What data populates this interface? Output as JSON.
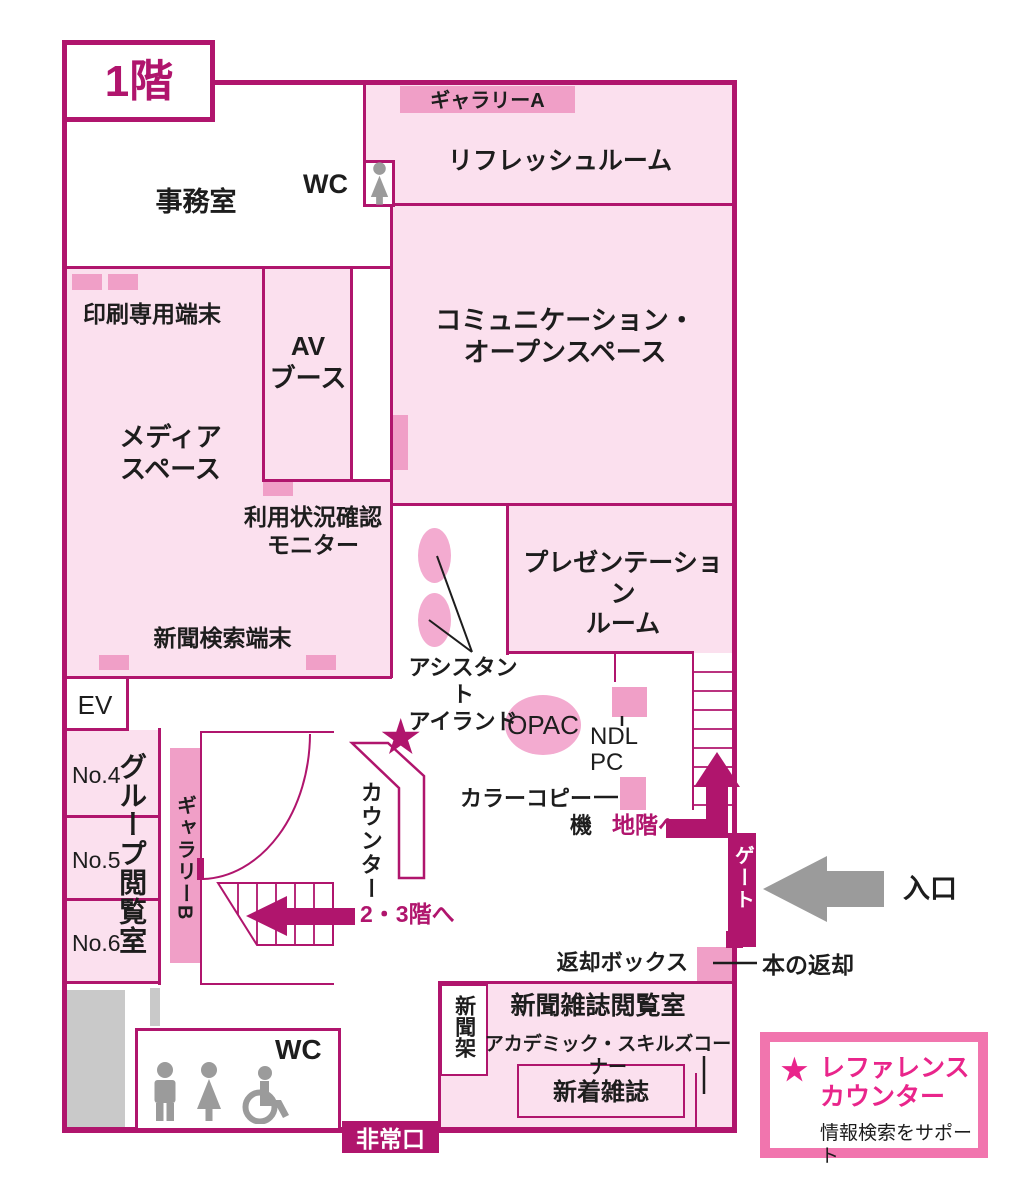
{
  "colors": {
    "wall": "#b0156d",
    "light_pink": "#fbe0ee",
    "accent_pink": "#f09fc7",
    "soft_pink": "#f3abd0",
    "hot_pink": "#e9258b",
    "legend_border": "#f175ae",
    "gray": "#9b9b9b",
    "light_gray": "#c9c9c9",
    "text": "#1d1d1d"
  },
  "header": {
    "floor_title": "1階"
  },
  "map": {
    "office": "事務室",
    "wc_top": "WC",
    "gallery_a": "ギャラリーA",
    "refresh_room": "リフレッシュルーム",
    "communication": "コミュニケーション・\nオープンスペース",
    "print_terminal": "印刷専用端末",
    "av_booth": "AV\nブース",
    "media_space": "メディア\nスペース",
    "usage_monitor": "利用状況確認\nモニター",
    "newspaper_terminal": "新聞検索端末",
    "presentation": "プレゼンテーション\nルーム",
    "assistant_island": "アシスタント\nアイランド",
    "opac": "OPAC",
    "ndl_pc": "NDL\nPC",
    "color_copier": "カラーコピー機",
    "to_basement": "地階へ",
    "ev": "EV",
    "group_no4": "No.4",
    "group_no5": "No.5",
    "group_no6": "No.6",
    "group_label": "グループ閲覧室",
    "gallery_b": "ギャラリーB",
    "counter": "カウンター",
    "to_floor23": "2・3階へ",
    "gate": "ゲート",
    "entrance": "入口",
    "return_box": "返却ボックス",
    "book_return": "本の返却",
    "newspaper_rack": "新聞架",
    "newspaper_room": "新聞雑誌閲覧室",
    "academic_corner": "アカデミック・スキルズコーナー",
    "new_magazines": "新着雑誌",
    "wc_bottom": "WC",
    "emergency_exit": "非常口",
    "star": "★"
  },
  "legend": {
    "star": "★",
    "title": "レファレンス\nカウンター",
    "subtitle": "情報検索をサポート"
  }
}
